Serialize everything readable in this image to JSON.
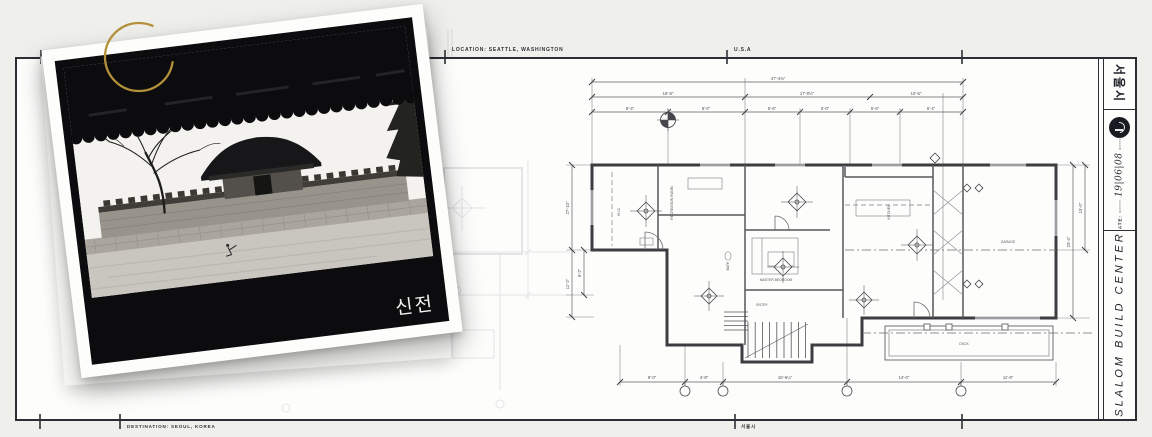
{
  "sheet": {
    "top_annotations": {
      "location": "LOCATION: SEATTLE, WASHINGTON",
      "country": "U.S.A"
    },
    "bottom_annotations": {
      "destination": "DESTINATION: SEOUL, KOREA",
      "city": "서울시"
    }
  },
  "polaroid": {
    "caption": "신전"
  },
  "title_block": {
    "region": "서울시",
    "date_label": "DATE:",
    "date_value": "19|06|08",
    "studio": "SLALOM BUILD CENTER",
    "logo_icon": "circular-seal-icon"
  },
  "plan": {
    "dims": {
      "t1": [
        "47'-4¾\""
      ],
      "t2": [
        "16'-8\"",
        "17'-0½\"",
        "10'-6\""
      ],
      "t3": [
        "8'-4\"",
        "8'-0\"",
        "5'-6\"",
        "5'-0\"",
        "5'-6\"",
        "6'-4\""
      ],
      "left": [
        "27'-10\"",
        "11'-2\"",
        "9'-2\""
      ],
      "right": [
        "23'-4\"",
        "15'-0\""
      ],
      "bottom": [
        "8'-0\"",
        "4'-8\"",
        "15'-6¼\"",
        "14'-0\"",
        "11'-9\""
      ]
    },
    "labels": [
      "RECREATION ROOM",
      "MASTER BEDROOM",
      "KITCHEN",
      "GARAGE",
      "ENTRY",
      "DECK",
      "BATH",
      "W.I.C"
    ]
  },
  "colors": {
    "accent_gold": "#b3913b",
    "frame_ink": "#2b2e35",
    "plan_line": "#55565a"
  }
}
